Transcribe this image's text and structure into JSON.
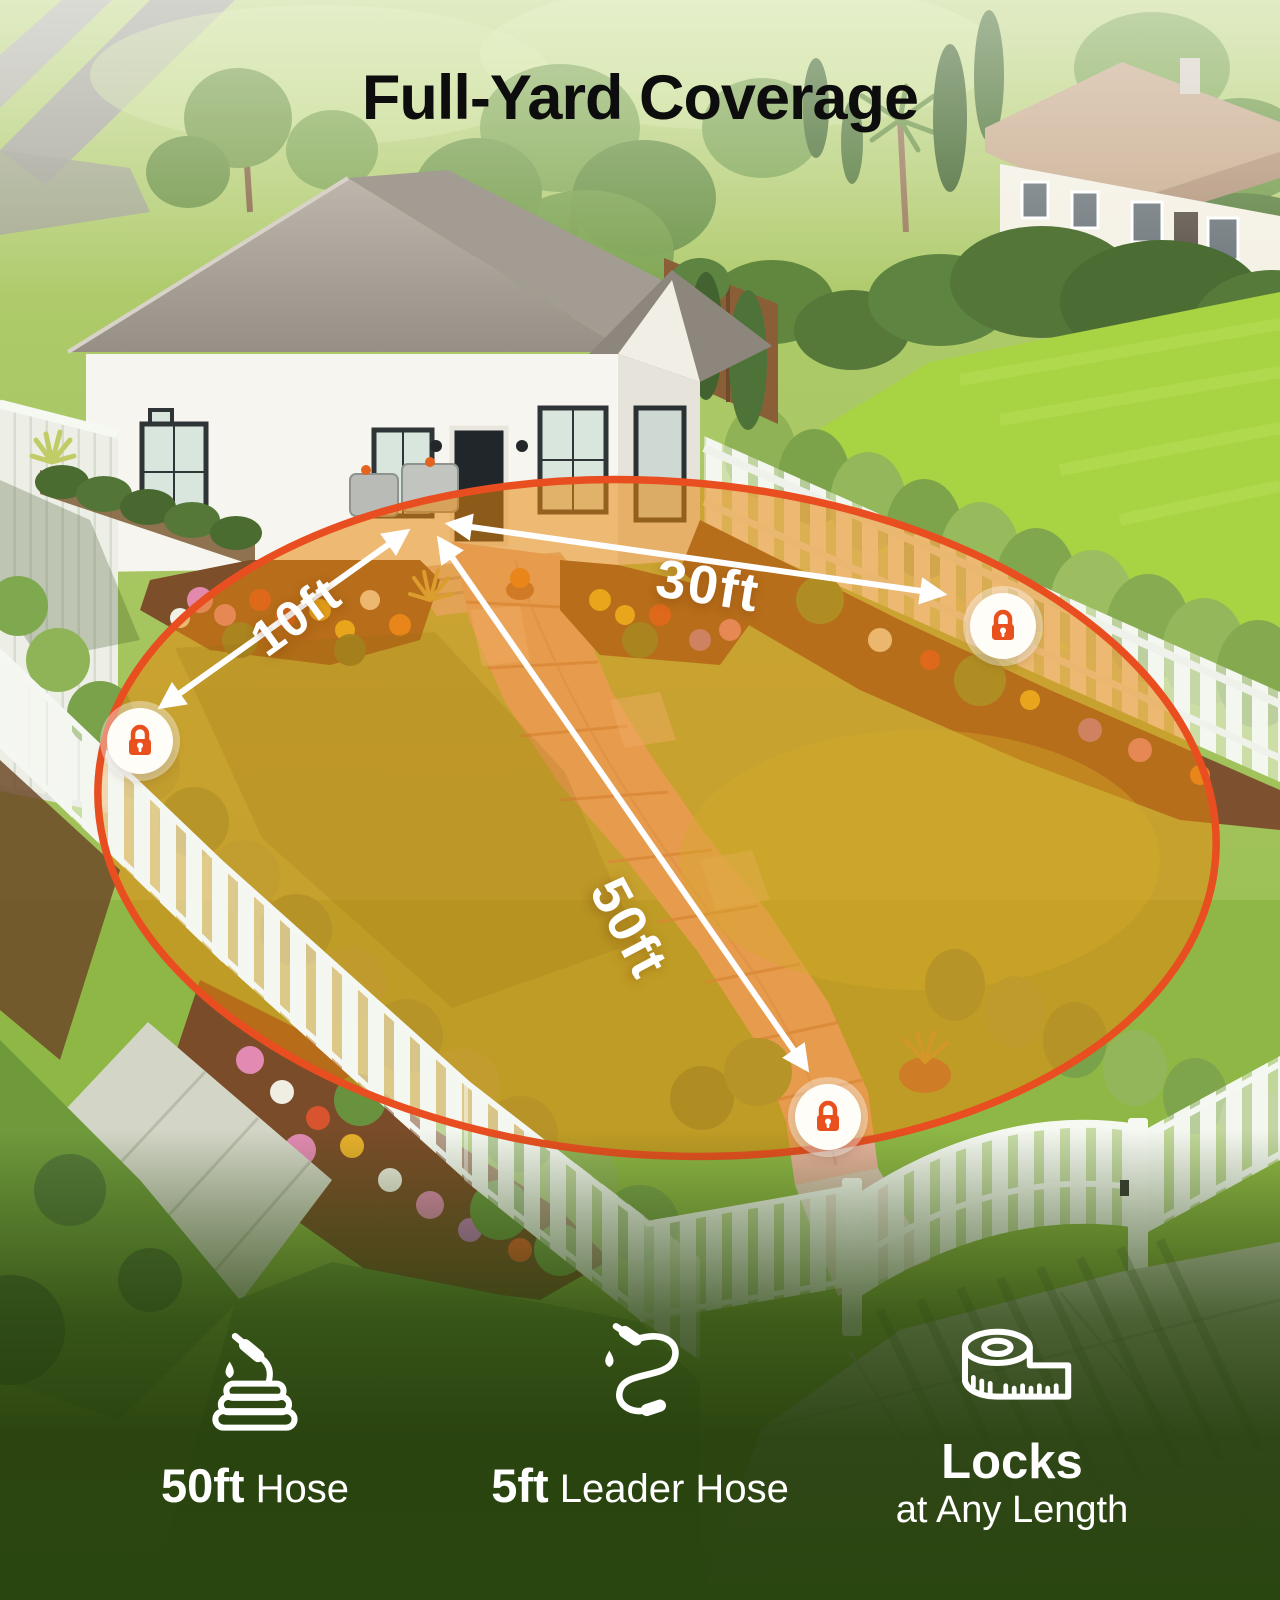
{
  "title": "Full-Yard Coverage",
  "coverage": {
    "measurements": [
      {
        "label": "10ft"
      },
      {
        "label": "30ft"
      },
      {
        "label": "50ft"
      }
    ],
    "lock_icon": "lock-icon",
    "ring_color": "#e84e20",
    "fill_color": "#e8870b"
  },
  "features": [
    {
      "icon": "hose-reel-icon",
      "value": "50ft",
      "label": "Hose"
    },
    {
      "icon": "leader-hose-icon",
      "value": "5ft",
      "label": "Leader Hose"
    },
    {
      "icon": "tape-measure-icon",
      "value": "Locks",
      "label": "at Any Length"
    }
  ],
  "colors": {
    "title_text": "#0d0d0d",
    "annotation_text": "#ffffff",
    "footer_green": "#2a4610"
  }
}
